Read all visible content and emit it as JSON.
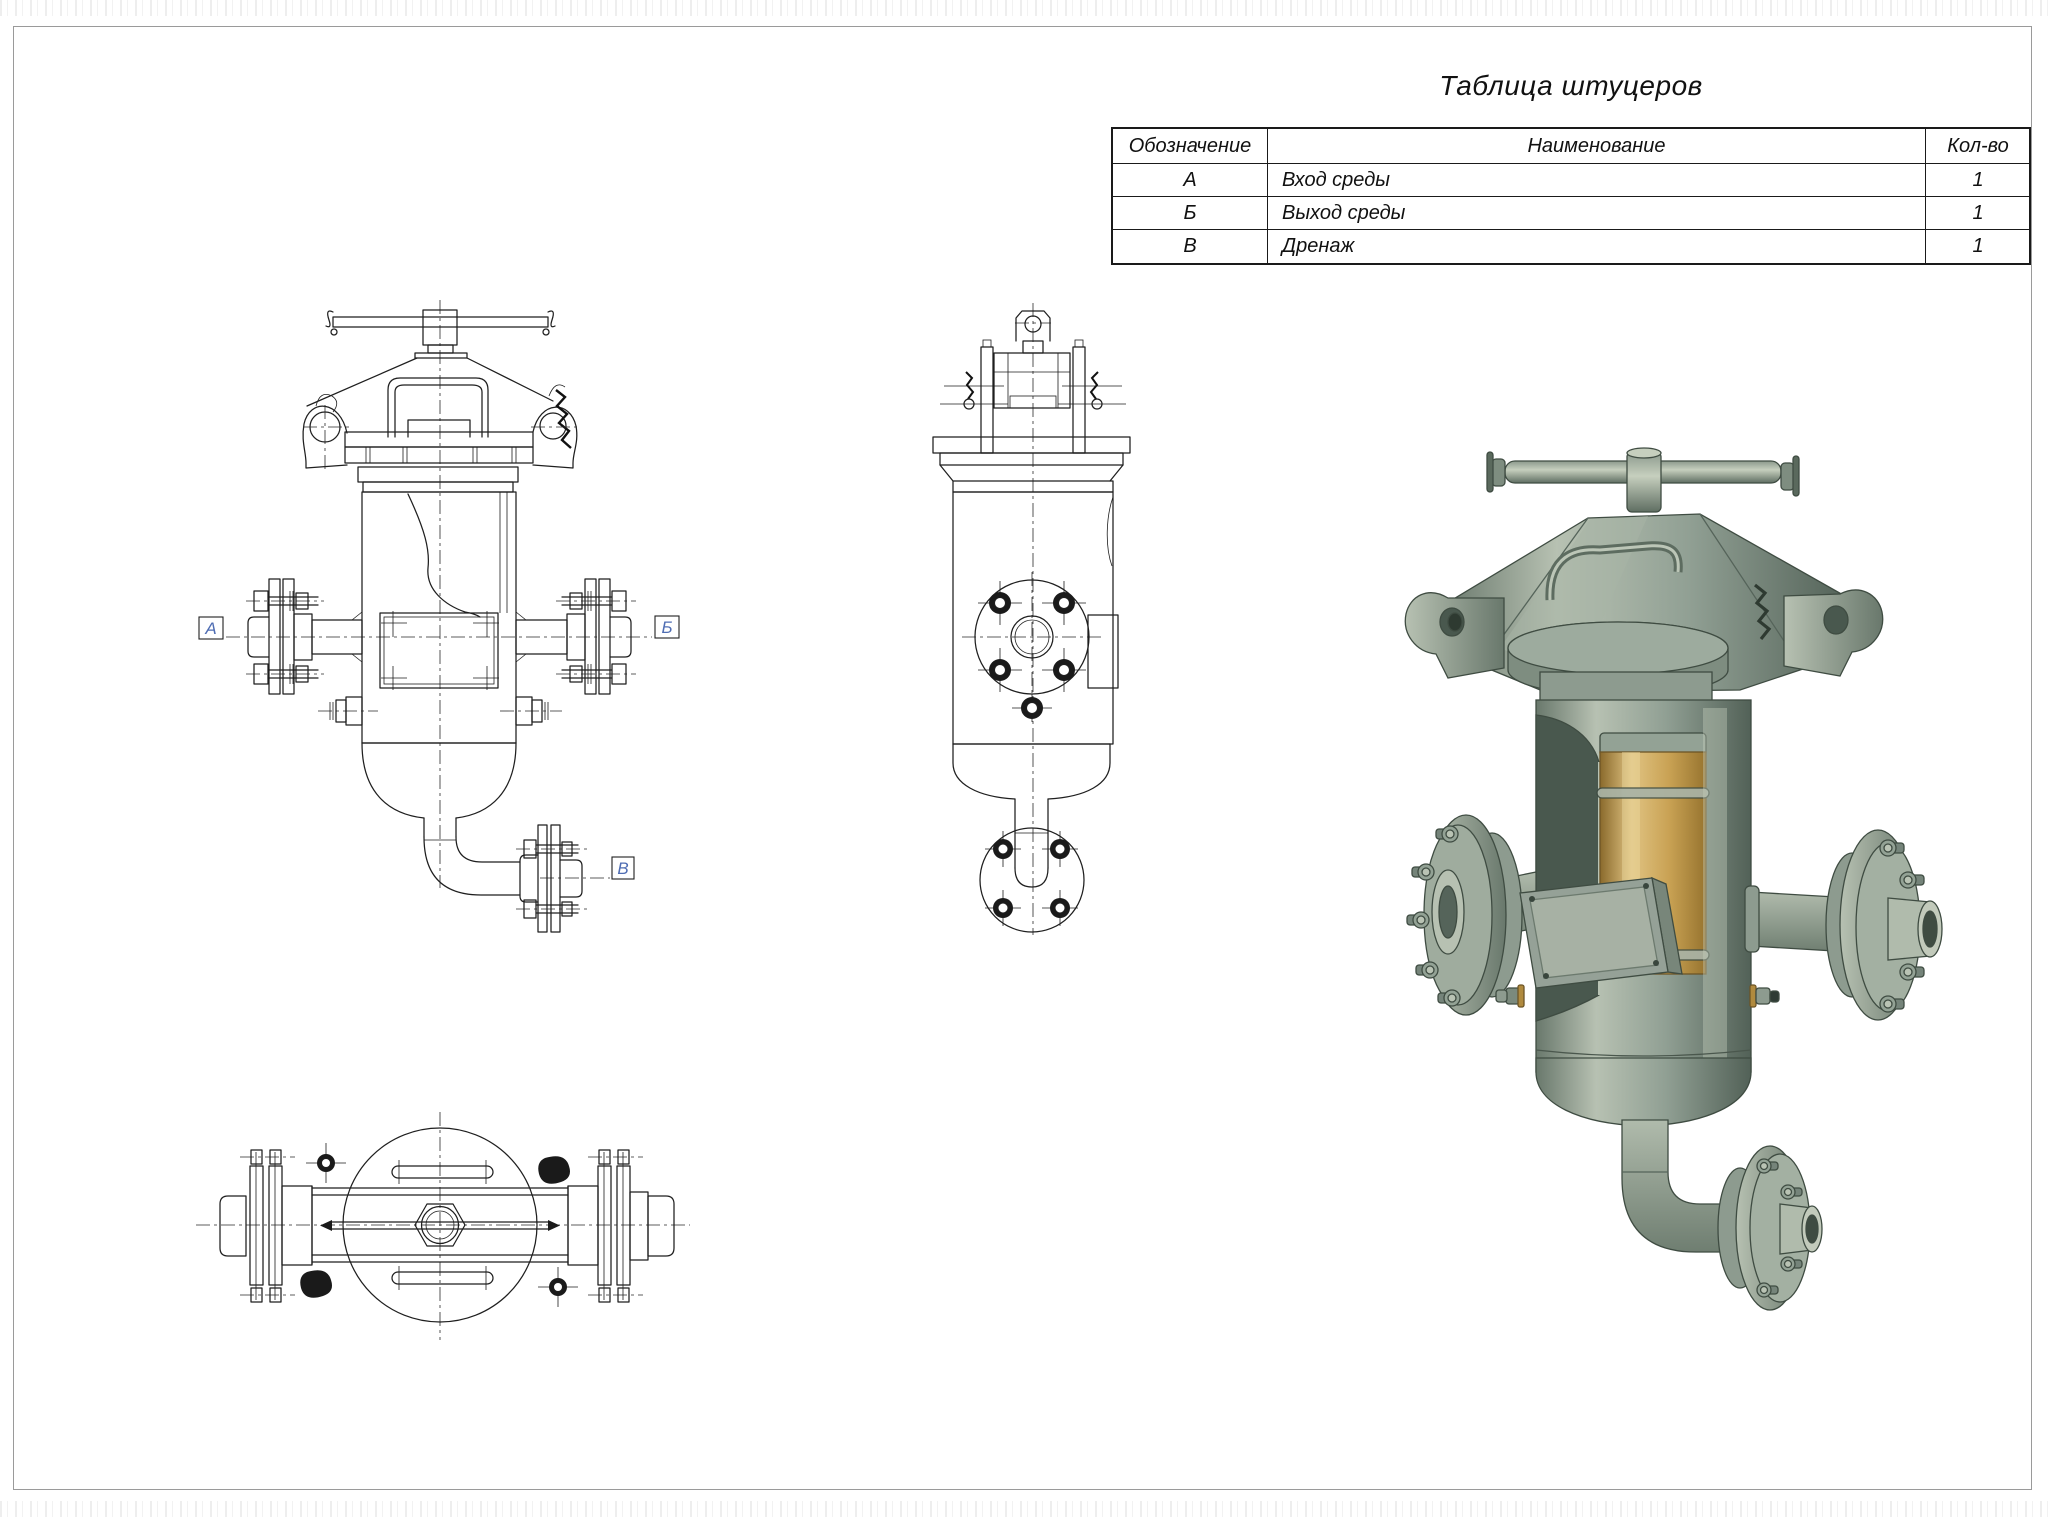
{
  "page": {
    "kind": "engineering-drawing",
    "background": "#ffffff",
    "frame_color": "#9a9a9a"
  },
  "nozzle_table": {
    "title": "Таблица штуцеров",
    "headers": {
      "designation": "Обозначение",
      "name": "Наименование",
      "qty": "Кол-во"
    },
    "rows": [
      {
        "designation": "А",
        "name": "Вход среды",
        "qty": "1"
      },
      {
        "designation": "Б",
        "name": "Выход среды",
        "qty": "1"
      },
      {
        "designation": "В",
        "name": "Дренаж",
        "qty": "1"
      }
    ]
  },
  "views": {
    "front": {
      "title": "front-orthographic-view",
      "labels": {
        "inlet": "А",
        "outlet": "Б",
        "drain": "В"
      }
    },
    "side": {
      "title": "side-orthographic-view"
    },
    "top": {
      "title": "top-orthographic-view"
    },
    "iso": {
      "title": "3d-shaded-view"
    }
  },
  "colors": {
    "drawing_line": "#1f1f1f",
    "label_letter": "#4f6db3",
    "body_metal": "#94a296",
    "body_highlight": "#c2cabb",
    "body_shadow": "#5d6c60",
    "cartridge_gold": "#c9a254",
    "interior_dark": "#49584e"
  }
}
